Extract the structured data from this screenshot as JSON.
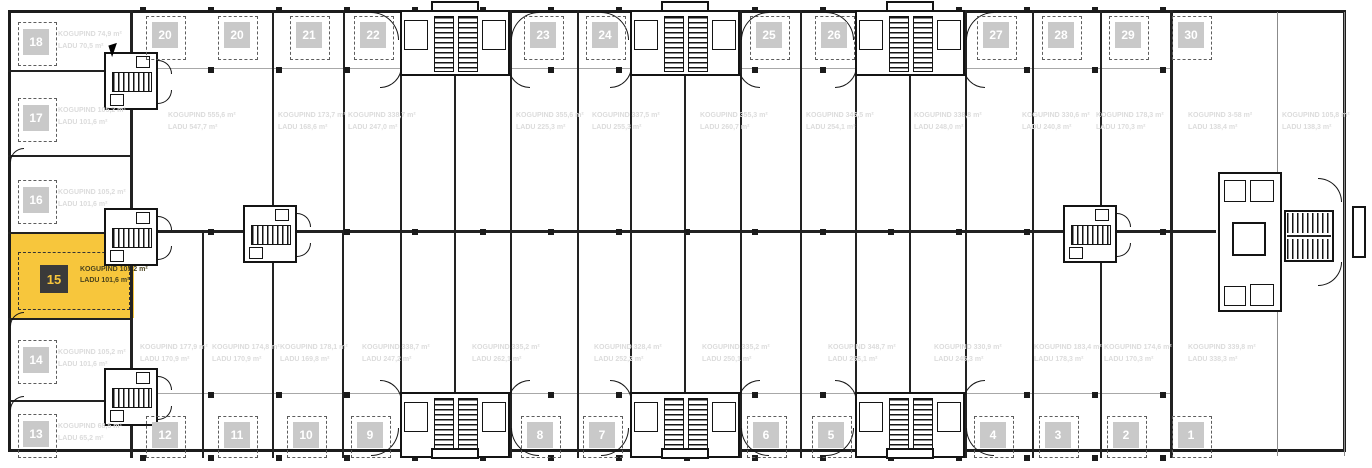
{
  "title": "Floor plan unit selector",
  "colors": {
    "highlight": "#F7C63C",
    "badge_bg": "#c9c9c9",
    "badge_text": "#ffffff",
    "selected_badge_bg": "#3a3a3a",
    "selected_badge_text": "#F7C63C",
    "faint_label": "#dcdcdc",
    "wall": "#222222"
  },
  "selected_unit": {
    "number": "15",
    "kogupind": "KOGUPIND 105,2 m²",
    "ladu": "LADU 101,6 m²"
  },
  "left_units": [
    {
      "number": "18",
      "x": 18,
      "y": 22,
      "label1": "KOGUPIND 74,9 m²",
      "label2": "LADU 70,5 m²"
    },
    {
      "number": "17",
      "x": 18,
      "y": 98,
      "label1": "KOGUPIND 105,2 m²",
      "label2": "LADU 101,6 m²"
    },
    {
      "number": "16",
      "x": 18,
      "y": 180,
      "label1": "KOGUPIND 105,2 m²",
      "label2": "LADU 101,6 m²"
    },
    {
      "number": "14",
      "x": 18,
      "y": 340,
      "label1": "KOGUPIND 105,2 m²",
      "label2": "LADU 101,6 m²"
    },
    {
      "number": "13",
      "x": 18,
      "y": 414,
      "label1": "KOGUPIND 68,5 m²",
      "label2": "LADU 65,2 m²"
    }
  ],
  "top_units": [
    {
      "number": "20",
      "x": 146
    },
    {
      "number": "20",
      "x": 218
    },
    {
      "number": "21",
      "x": 290
    },
    {
      "number": "22",
      "x": 354
    },
    {
      "number": "23",
      "x": 524
    },
    {
      "number": "24",
      "x": 586
    },
    {
      "number": "25",
      "x": 750
    },
    {
      "number": "26",
      "x": 815
    },
    {
      "number": "27",
      "x": 977
    },
    {
      "number": "28",
      "x": 1042
    },
    {
      "number": "29",
      "x": 1109
    },
    {
      "number": "30",
      "x": 1172
    }
  ],
  "bottom_units": [
    {
      "number": "12",
      "x": 146
    },
    {
      "number": "11",
      "x": 218
    },
    {
      "number": "10",
      "x": 287
    },
    {
      "number": "9",
      "x": 351
    },
    {
      "number": "8",
      "x": 521
    },
    {
      "number": "7",
      "x": 583
    },
    {
      "number": "6",
      "x": 747
    },
    {
      "number": "5",
      "x": 812
    },
    {
      "number": "4",
      "x": 974
    },
    {
      "number": "3",
      "x": 1039
    },
    {
      "number": "2",
      "x": 1107
    },
    {
      "number": "1",
      "x": 1172
    }
  ],
  "hall_labels_top": [
    {
      "x": 168,
      "line1": "KOGUPIND 555,6 m²",
      "line2": "LADU 547,7 m²"
    },
    {
      "x": 278,
      "line1": "KOGUPIND 173,7 m²",
      "line2": "LADU 168,6 m²"
    },
    {
      "x": 348,
      "line1": "KOGUPIND 338,7 m²",
      "line2": "LADU 247,0 m²"
    },
    {
      "x": 516,
      "line1": "KOGUPIND 355,6 m²",
      "line2": "LADU 225,3 m²"
    },
    {
      "x": 592,
      "line1": "KOGUPIND 337,5 m²",
      "line2": "LADU 255,3 m²"
    },
    {
      "x": 700,
      "line1": "KOGUPIND 355,3 m²",
      "line2": "LADU 260,7 m²"
    },
    {
      "x": 806,
      "line1": "KOGUPIND 346,5 m²",
      "line2": "LADU 254,1 m²"
    },
    {
      "x": 914,
      "line1": "KOGUPIND 338,8 m²",
      "line2": "LADU 248,0 m²"
    },
    {
      "x": 1022,
      "line1": "KOGUPIND 330,6 m²",
      "line2": "LADU 240,8 m²"
    },
    {
      "x": 1096,
      "line1": "KOGUPIND 178,3 m²",
      "line2": "LADU 170,3 m²"
    },
    {
      "x": 1188,
      "line1": "KOGUPIND 3-58 m²",
      "line2": "LADU 138,4 m²"
    },
    {
      "x": 1282,
      "line1": "KOGUPIND 105,8 m²",
      "line2": "LADU 138,3 m²"
    }
  ],
  "hall_labels_bottom": [
    {
      "x": 140,
      "line1": "KOGUPIND 177,9 m²",
      "line2": "LADU 170,9 m²"
    },
    {
      "x": 212,
      "line1": "KOGUPIND 174,8 m²",
      "line2": "LADU 170,9 m²"
    },
    {
      "x": 280,
      "line1": "KOGUPIND 178,1 m²",
      "line2": "LADU 169,8 m²"
    },
    {
      "x": 362,
      "line1": "KOGUPIND 338,7 m²",
      "line2": "LADU 247,2 m²"
    },
    {
      "x": 472,
      "line1": "KOGUPIND 335,2 m²",
      "line2": "LADU 262,1 m²"
    },
    {
      "x": 594,
      "line1": "KOGUPIND 328,4 m²",
      "line2": "LADU 252,2 m²"
    },
    {
      "x": 702,
      "line1": "KOGUPIND 335,2 m²",
      "line2": "LADU 250,1 m²"
    },
    {
      "x": 828,
      "line1": "KOGUPIND 348,7 m²",
      "line2": "LADU 256,1 m²"
    },
    {
      "x": 934,
      "line1": "KOGUPIND 330,9 m²",
      "line2": "LADU 245,3 m²"
    },
    {
      "x": 1034,
      "line1": "KOGUPIND 183,4 m²",
      "line2": "LADU 178,3 m²"
    },
    {
      "x": 1104,
      "line1": "KOGUPIND 174,6 m²",
      "line2": "LADU 170,3 m²"
    },
    {
      "x": 1188,
      "line1": "KOGUPIND 339,8 m²",
      "line2": "LADU 338,3 m²"
    }
  ]
}
